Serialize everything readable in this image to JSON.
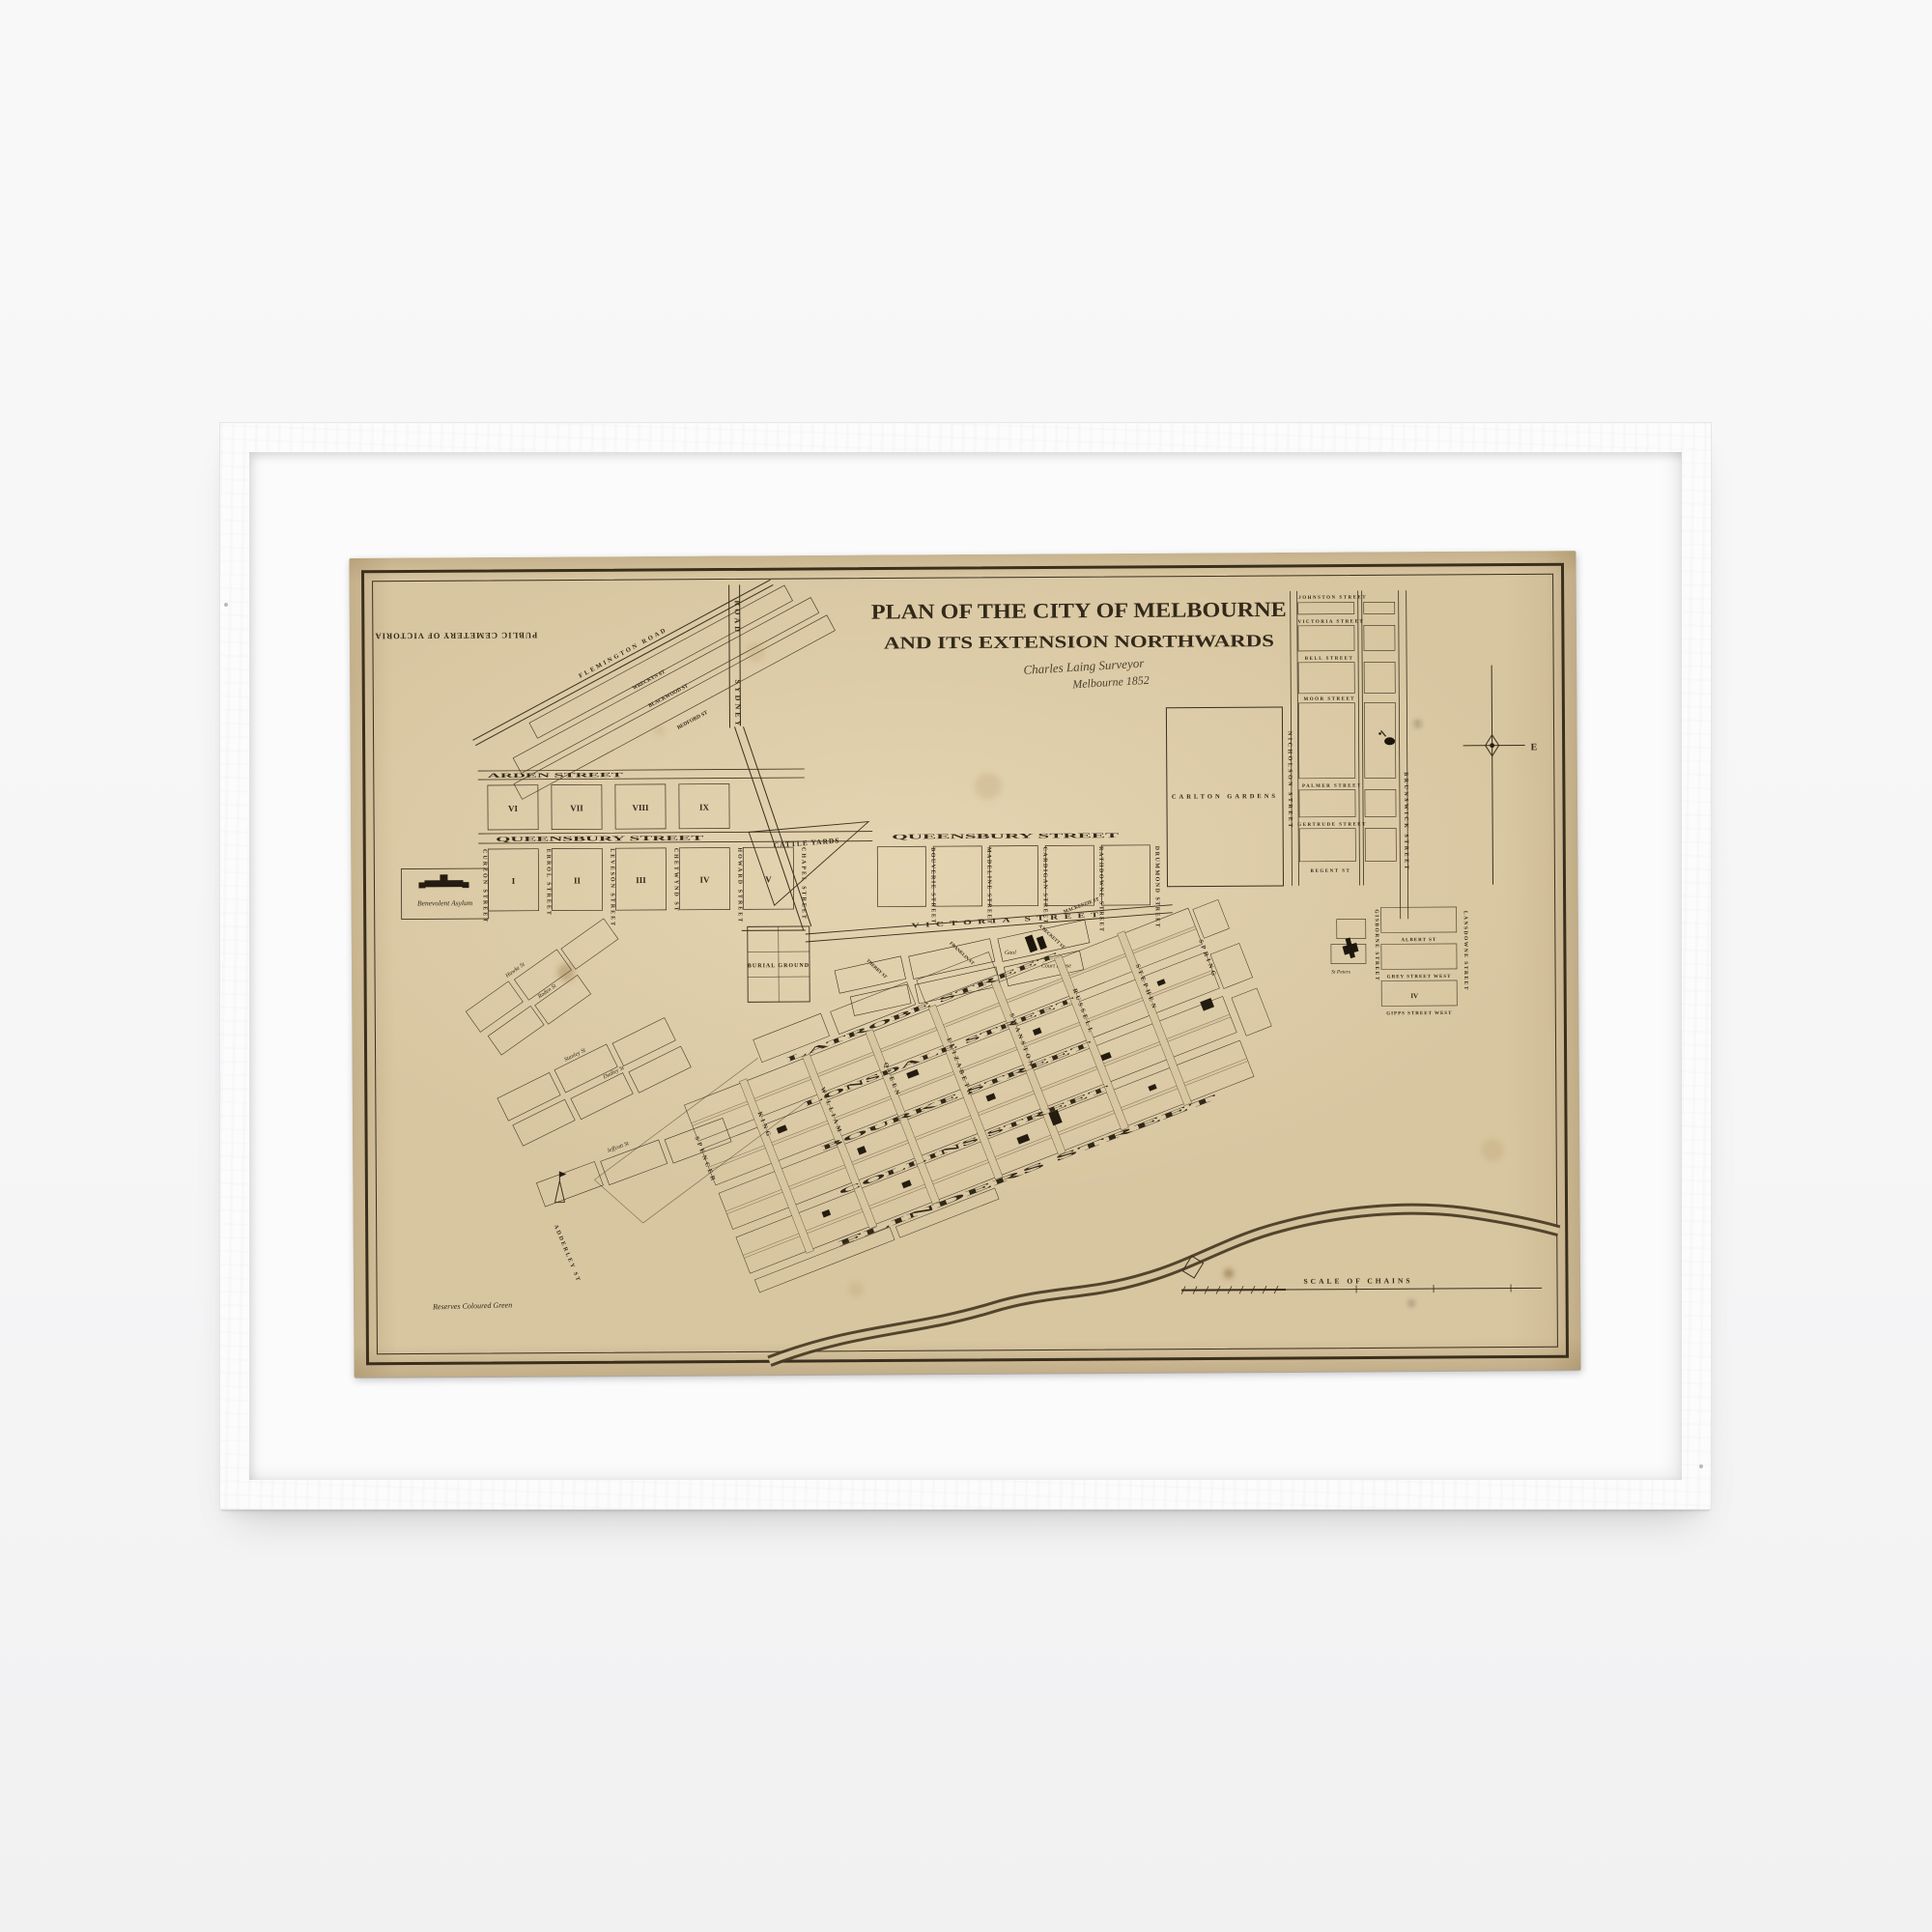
{
  "artwork": {
    "kind": "framed vintage map print",
    "title_line1": "PLAN OF THE CITY OF MELBOURNE",
    "title_line2": "AND ITS EXTENSION NORTHWARDS",
    "signature_line1": "Charles Laing Surveyor",
    "signature_line2": "Melbourne 1852"
  },
  "colors": {
    "wall": "#f6f6f7",
    "frame": "#fcfcfd",
    "mat": "#fbfbfc",
    "paper": "#d8c6a1",
    "ink": "#32291a"
  },
  "map": {
    "rotated_note": "PUBLIC CEMETERY OF VICTORIA",
    "roads": {
      "sydney_word1": "ROAD",
      "sydney_word2": "SYDNEY",
      "flemington": "FLEMINGTON ROAD"
    },
    "hotham": {
      "fan_streets": [
        "WRECKYN ST",
        "BLACKWOOD ST",
        "BEDFORD ST"
      ],
      "arden": "ARDEN STREET",
      "queensbury": "QUEENSBURY STREET",
      "verticals": [
        "CURZON STREET",
        "ERROL STREET",
        "LEVESON STREET",
        "CHETWYND ST",
        "HOWARD STREET",
        "CHAPEL STREET"
      ],
      "numerals_top": [
        "VI",
        "VII",
        "VIII",
        "IX"
      ],
      "numerals_bottom": [
        "I",
        "II",
        "III",
        "IV",
        "V"
      ],
      "asylum": "Benevolent Asylum"
    },
    "carlton": {
      "queensbury": "QUEENSBURY STREET",
      "verticals": [
        "BOUVERIE STREET",
        "MADELINE STREET",
        "CARDIGAN STREET",
        "RATHDOWNE STREET",
        "DRUMMOND STREET"
      ],
      "victoria": "VICTORIA STREET",
      "gardens": "CARLTON GARDENS",
      "cattle_yards": "CATTLE YARDS",
      "burial_ground": "BURIAL GROUND",
      "gaol": "Gaol",
      "court_house": "Court House",
      "mackenzie": "MACKENZIE ST"
    },
    "fringe_streets": [
      "THERRY ST",
      "FRANKLIN ST",
      "A'BECKETT ST"
    ],
    "fitzroy": {
      "horizontals": [
        "JOHNSTON STREET",
        "VICTORIA STREET",
        "BELL STREET",
        "MOOR STREET",
        "PALMER STREET",
        "GERTRUDE STREET",
        "REGENT ST"
      ],
      "nicholson": "NICHOLSON STREET",
      "brunswick": "BRUNSWICK STREET"
    },
    "east_melbourne": {
      "verticals": [
        "GISBORNE STREET",
        "LANSDOWNE STREET"
      ],
      "horizontals": [
        "ALBERT ST",
        "GREY STREET WEST",
        "GIPPS STREET WEST"
      ],
      "church": "St Peters",
      "numeral": "IV"
    },
    "cbd": {
      "long_streets": [
        "LATROBE STREET",
        "LONSDALE STREET",
        "BOURKE STREET",
        "COLLINS STREET",
        "FLINDERS STREET"
      ],
      "cross_streets": [
        "SPENCER",
        "KING",
        "WILLIAM",
        "QUEEN",
        "ELIZABETH",
        "SWANSTON",
        "RUSSELL",
        "STEPHEN",
        "SPRING"
      ]
    },
    "west_melbourne": {
      "scripts": [
        "Hawke St",
        "Roden St",
        "Stanley St",
        "Dudley St",
        "Jeffcott St"
      ],
      "adderley": "ADDERLEY ST"
    },
    "scale_label": "SCALE OF CHAINS",
    "reserves_note": "Reserves Coloured Green",
    "compass_east": "E"
  }
}
